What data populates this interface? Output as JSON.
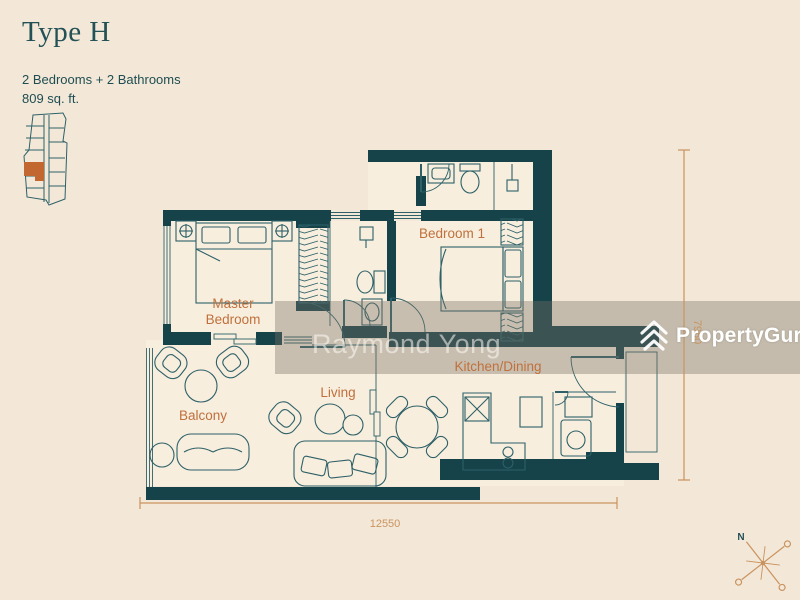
{
  "header": {
    "title": "Type H",
    "specs": "2 Bedrooms + 2 Bathrooms",
    "area": "809 sq. ft."
  },
  "key_plan": {
    "description": "building-site-key-plan",
    "unit_highlight_color": "#c2672f"
  },
  "plan": {
    "labels": {
      "master_line1": "Master",
      "master_line2": "Bedroom",
      "bedroom1": "Bedroom 1",
      "living": "Living",
      "kitchen_dining": "Kitchen/Dining",
      "balcony": "Balcony"
    },
    "dimensions": {
      "width": "12550",
      "height": "7960"
    },
    "colors": {
      "wall": "#16424a",
      "line": "#2e6068",
      "label": "#c0703c",
      "dimension": "#c9935f",
      "floor": "#f7eede",
      "background": "#f3e8d8",
      "watermark_band": "rgba(122,113,100,0.38)"
    }
  },
  "watermark": {
    "agent": "Raymond Yong",
    "brand": "PropertyGuru"
  },
  "compass": {
    "north": "N"
  }
}
